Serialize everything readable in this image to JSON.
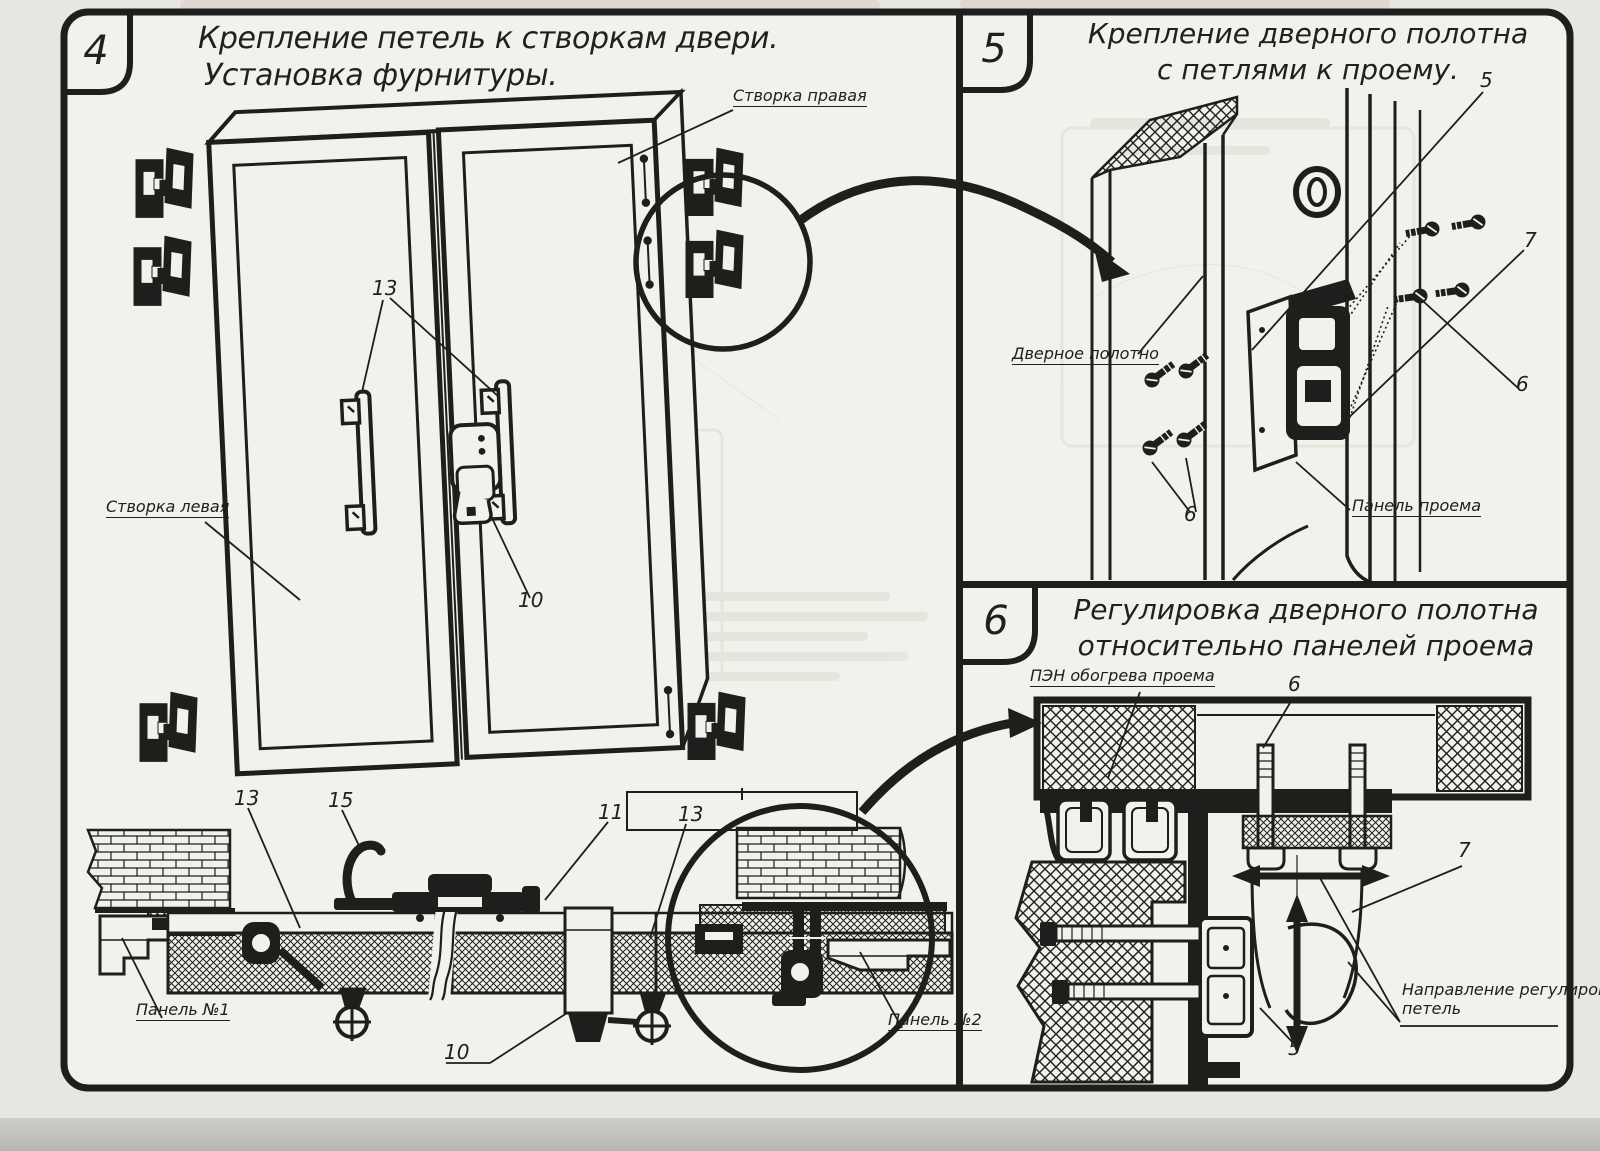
{
  "document": {
    "kind": "scanned technical instruction sheet",
    "ink": "#1f1e1c",
    "paper": "#f3f1eb",
    "outside": "#e8e6e1"
  },
  "panel4": {
    "number": "4",
    "title": [
      "Крепление петель к створкам двери.",
      "Установка фурнитуры."
    ],
    "labels": {
      "leaf_right": "Створка правая",
      "leaf_left": "Створка левая",
      "panel_no1": "Панель №1",
      "panel_no2": "Панель №2"
    },
    "callouts": {
      "handles": "13",
      "lock": "10",
      "sec_plate_left": "13",
      "sec_hook": "15",
      "sec_clamp": "11",
      "sec_plate_right": "13",
      "sec_pocket": "10"
    }
  },
  "panel5": {
    "number": "5",
    "title": [
      "Крепление дверного полотна",
      "с петлями к проему."
    ],
    "labels": {
      "door_leaf": "Дверное полотно",
      "opening_panel": "Панель проема"
    },
    "callouts": {
      "hinge": "5",
      "bracket": "7",
      "screws_right": "6",
      "screws_left": "6"
    }
  },
  "panel6": {
    "number": "6",
    "title": [
      "Регулировка дверного полотна",
      "относительно панелей проема"
    ],
    "labels": {
      "heater": "ПЭН обогрева проема",
      "direction_line1": "Направление регулировки",
      "direction_line2": "петель"
    },
    "callouts": {
      "bolt": "6",
      "hinge_loop": "7",
      "profile": "5"
    }
  }
}
